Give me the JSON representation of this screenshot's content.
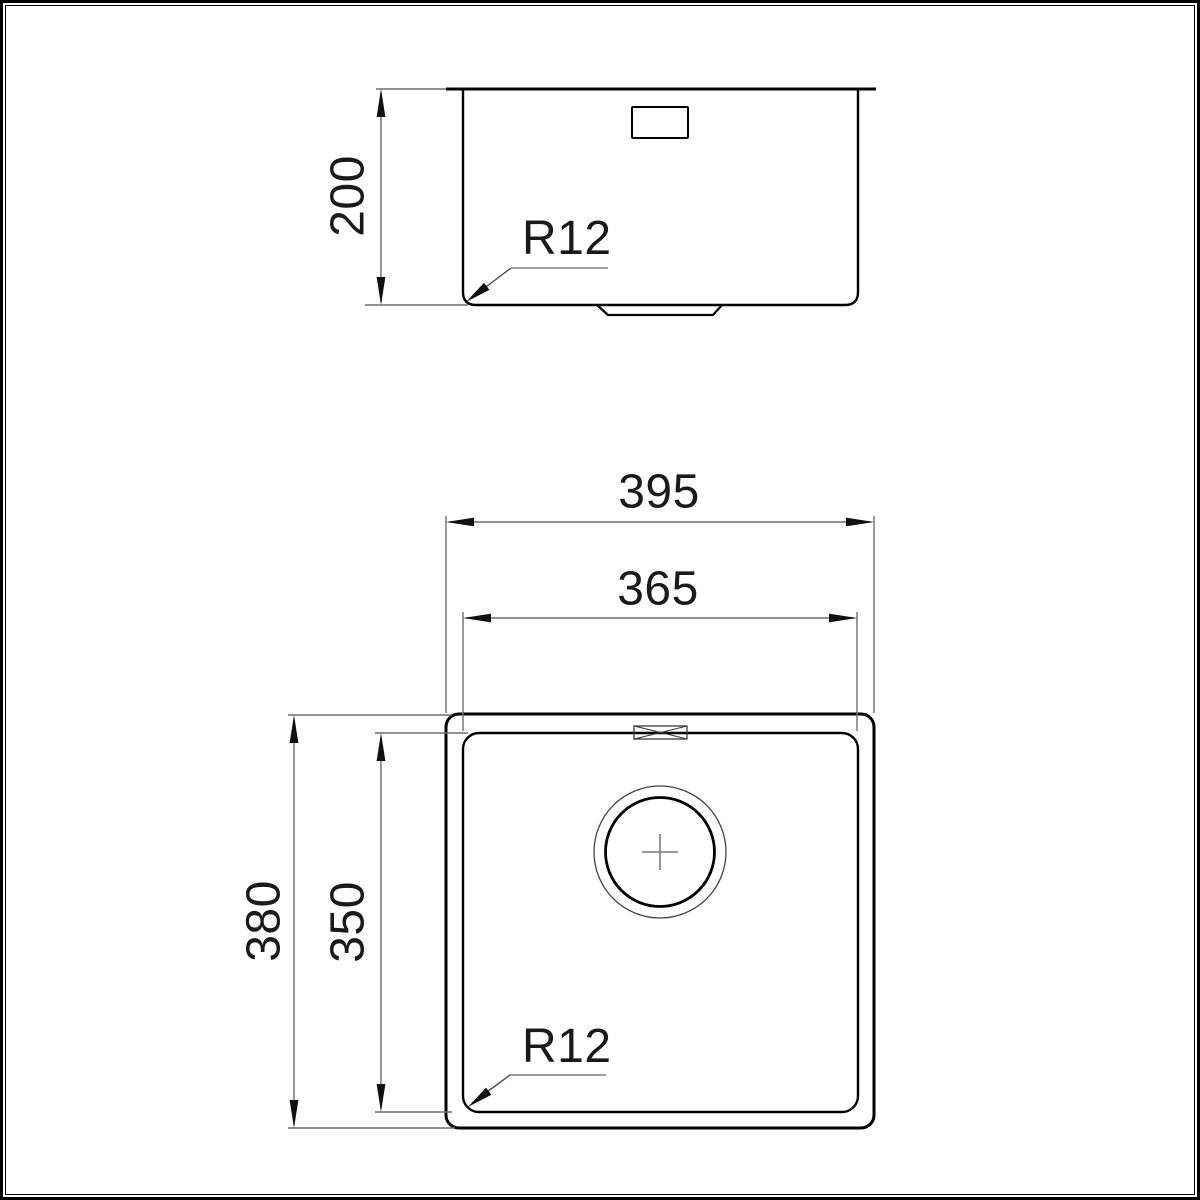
{
  "side_view": {
    "height_label": "200",
    "radius_label": "R12"
  },
  "plan_view": {
    "outer_width_label": "395",
    "inner_width_label": "365",
    "outer_depth_label": "380",
    "inner_depth_label": "350",
    "radius_label": "R12"
  },
  "colors": {
    "background": "#ffffff",
    "outline": "#000000",
    "dimension_line": "#6e6e6e",
    "leader_underline": "#9c9c9c",
    "arrow": "#111111",
    "text": "#1a1a1a"
  }
}
